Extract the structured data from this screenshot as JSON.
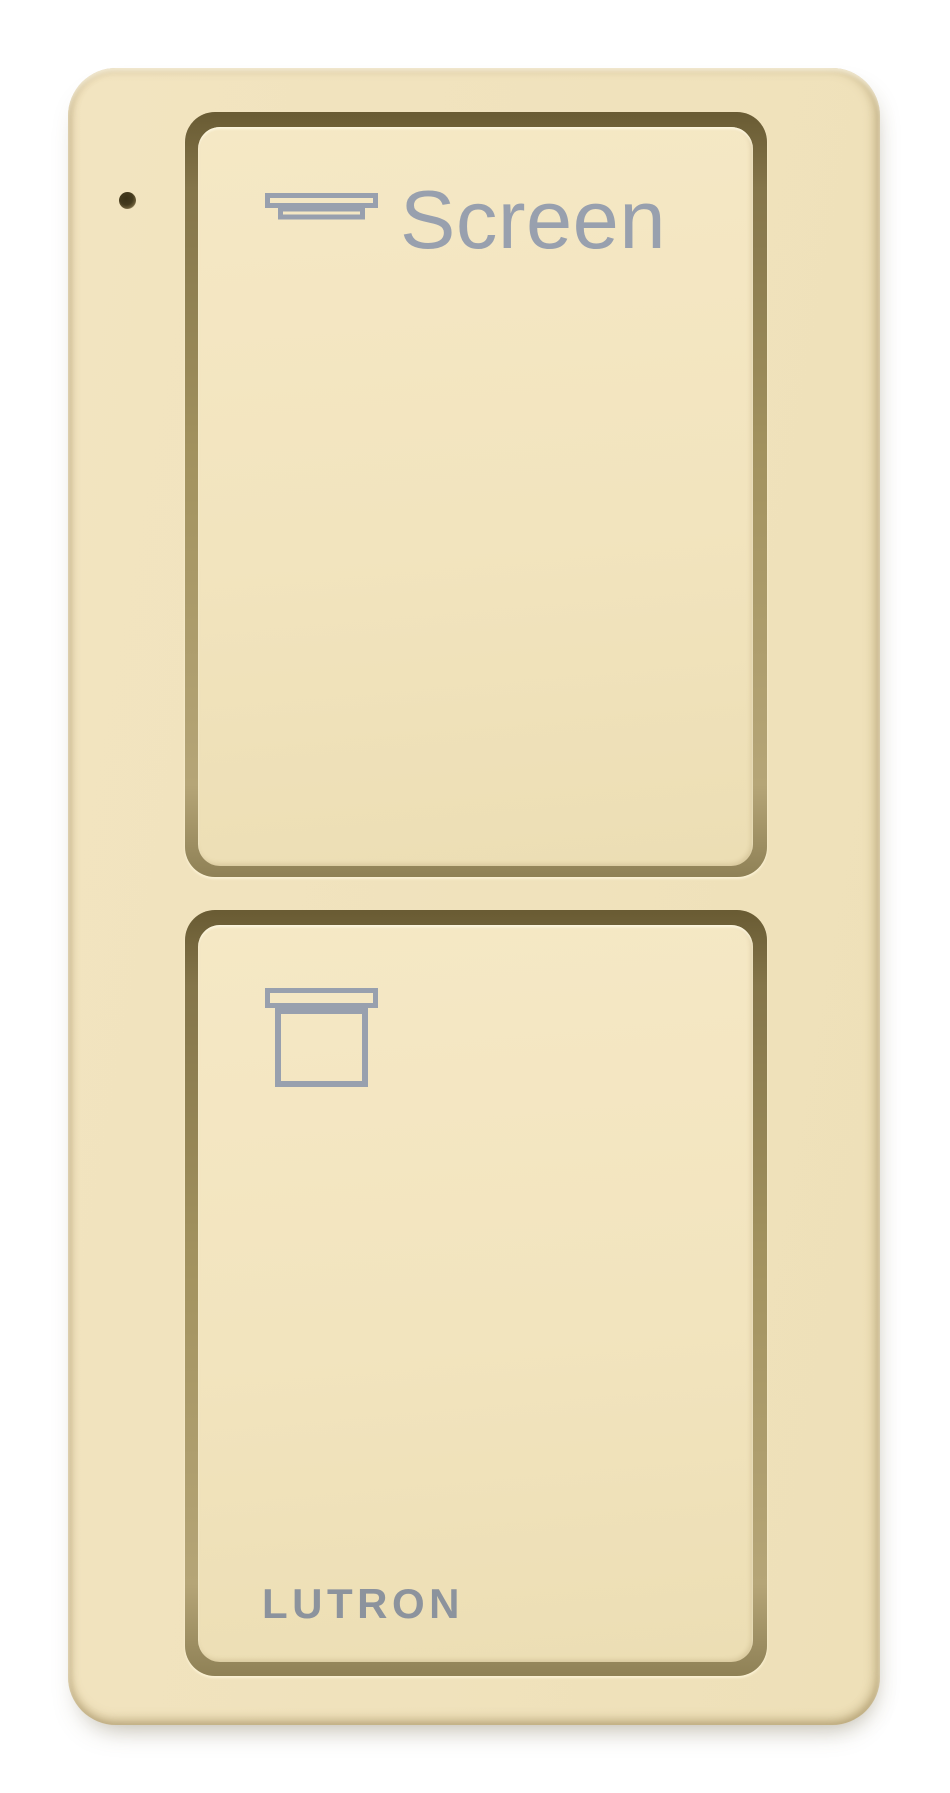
{
  "remote": {
    "brand": "LUTRON",
    "top_button": {
      "label": "Screen",
      "icon": "screen-raised-icon",
      "action": "raise-screen"
    },
    "bottom_button": {
      "icon": "screen-lowered-icon",
      "action": "lower-screen"
    },
    "led": {
      "icon": "led-indicator",
      "state": "off"
    },
    "colors": {
      "body": "#f0e2bc",
      "button_face": "#f2e4be",
      "groove": "#695b33",
      "groove_highlight": "#fdf4d8",
      "icon_gray": "#98a0ae",
      "brand_gray": "#8c939d",
      "led": "#443a1e",
      "background": "#ffffff"
    }
  }
}
